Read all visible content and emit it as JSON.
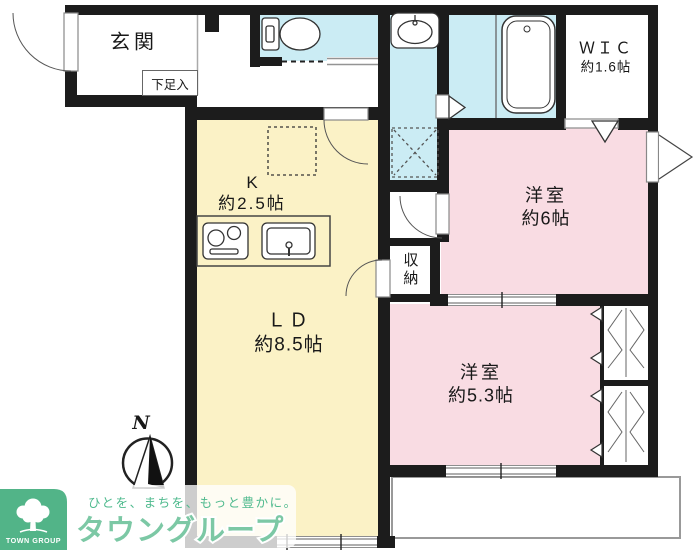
{
  "colors": {
    "wall": "#1c1c1c",
    "ldk": "#fbf2c6",
    "room": "#f9dce3",
    "wet": "#cbecf4",
    "logo-green": "#52b488",
    "logo-text": "#7cc8a5",
    "tagline": "#4fba8e"
  },
  "rooms": {
    "entrance": {
      "label": "玄関"
    },
    "shoe_storage": {
      "label": "下足入"
    },
    "kitchen": {
      "label": "K",
      "size": "約2.5帖"
    },
    "living_dining": {
      "label": "ＬＤ",
      "size": "約8.5帖"
    },
    "western_room_6": {
      "label": "洋室",
      "size": "約6帖"
    },
    "western_room_53": {
      "label": "洋室",
      "size": "約5.3帖"
    },
    "wic": {
      "label": "ＷＩＣ",
      "size": "約1.6帖"
    },
    "storage": {
      "label": "収納"
    }
  },
  "compass": {
    "north": "N"
  },
  "logo": {
    "mark": "TOWN GROUP",
    "tagline": "ひとを、まちを、もっと豊かに。",
    "name": "タウングループ"
  }
}
